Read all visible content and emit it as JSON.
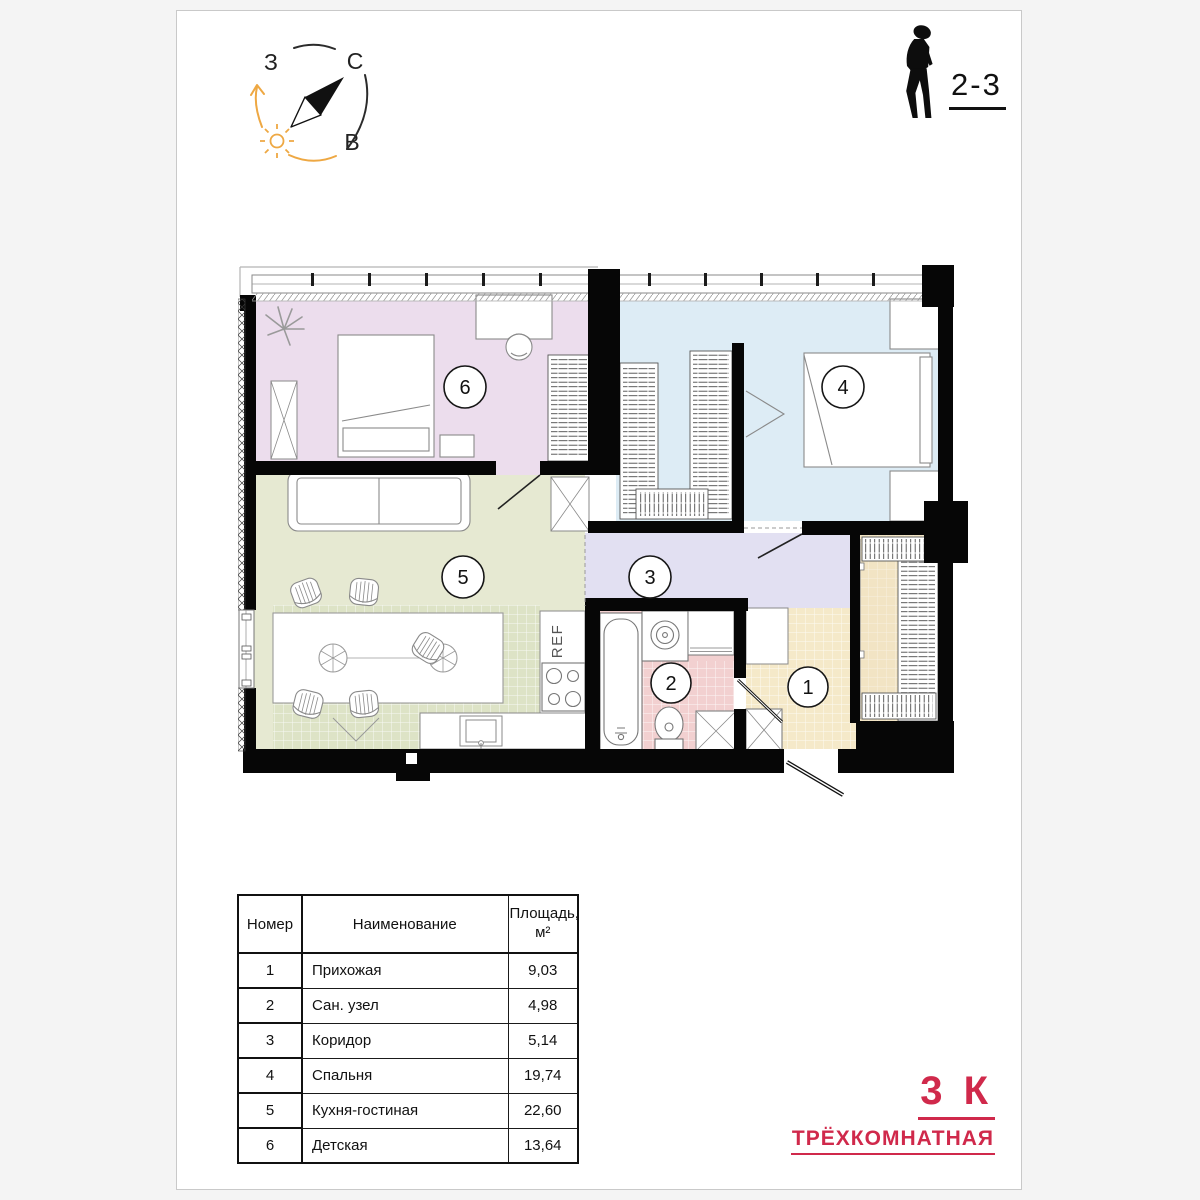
{
  "sheet": {
    "floor_label": "2-3"
  },
  "compass": {
    "west": "З",
    "north": "С",
    "east": "В",
    "accent_orange": "#eea843",
    "dark": "#2b2b2b"
  },
  "plan": {
    "rooms": [
      {
        "num": "1",
        "name": "Прихожая",
        "area": "9,03",
        "color": "#f5e9c9"
      },
      {
        "num": "2",
        "name": "Сан. узел",
        "area": "4,98",
        "color": "#f2d0d0"
      },
      {
        "num": "3",
        "name": "Коридор",
        "area": "5,14",
        "color": "#e2e0f2"
      },
      {
        "num": "4",
        "name": "Спальня",
        "area": "19,74",
        "color": "#ddecf5"
      },
      {
        "num": "5",
        "name": "Кухня-гостиная",
        "area": "22,60",
        "color": "#e6e9d2"
      },
      {
        "num": "6",
        "name": "Детская",
        "area": "13,64",
        "color": "#ecdded"
      }
    ],
    "fridge_label": "REF",
    "wall_color": "#060606",
    "kitchen_tile_color": "#dde3c6"
  },
  "table": {
    "headers": {
      "num": "Номер",
      "name": "Наименование",
      "area_line1": "Площадь,",
      "area_line2": "м²"
    }
  },
  "title": {
    "short": "3 К",
    "full": "ТРЁХКОМНАТНАЯ",
    "color": "#d0294b"
  }
}
